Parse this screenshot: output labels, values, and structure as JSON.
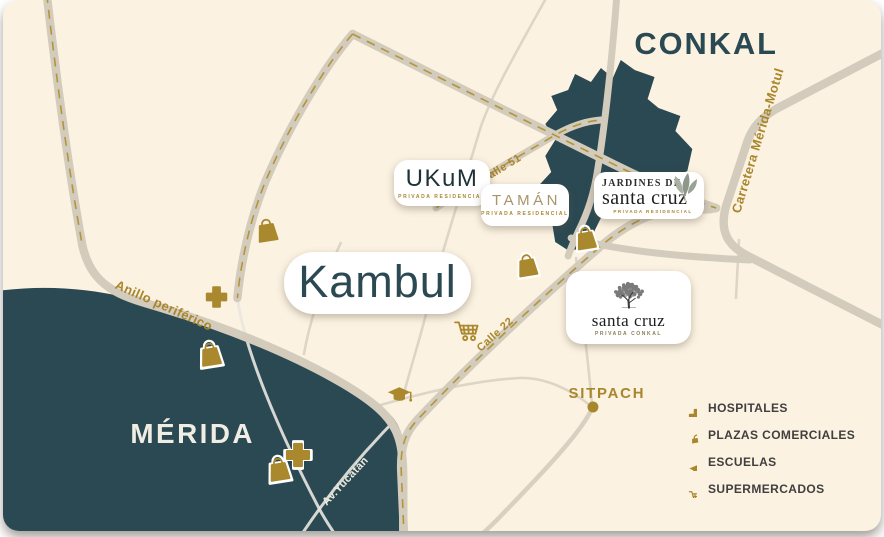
{
  "cities": {
    "conkal": "CONKAL",
    "merida": "MÉRIDA",
    "sitpach": "SITPACH"
  },
  "road_labels": {
    "anillo_periferico": "Anillo periférico",
    "calle_51": "Calle 51",
    "calle_22": "Calle 22",
    "carretera_merida_motul": "Carretera Mérida-Motul",
    "av_yucatan": "Av.Yucatán"
  },
  "developments": {
    "kambul": {
      "name": "Kambul"
    },
    "ukum": {
      "name": "UKuM",
      "tagline": "PRIVADA RESIDENCIAL"
    },
    "taman": {
      "name": "TAMÁN",
      "tagline": "PRIVADA RESIDENCIAL"
    },
    "jardines_santa_cruz": {
      "line1": "JARDINES DE",
      "line2": "santa cruz",
      "tagline": "PRIVADA RESIDENCIAL"
    },
    "santa_cruz": {
      "name": "santa cruz",
      "tagline": "PRIVADA CONKAL"
    }
  },
  "legend": {
    "items": [
      {
        "icon": "hospital-cross-icon",
        "label": "HOSPITALES"
      },
      {
        "icon": "shopping-bag-icon",
        "label": "PLAZAS COMERCIALES"
      },
      {
        "icon": "graduation-cap-icon",
        "label": "ESCUELAS"
      },
      {
        "icon": "shopping-cart-icon",
        "label": "SUPERMERCADOS"
      }
    ]
  },
  "colors": {
    "background": "#fcf2e1",
    "city_fill": "#2b4952",
    "road": "#d3ccbd",
    "accent_gold": "#a8862c",
    "light_label": "#f0eee4"
  }
}
